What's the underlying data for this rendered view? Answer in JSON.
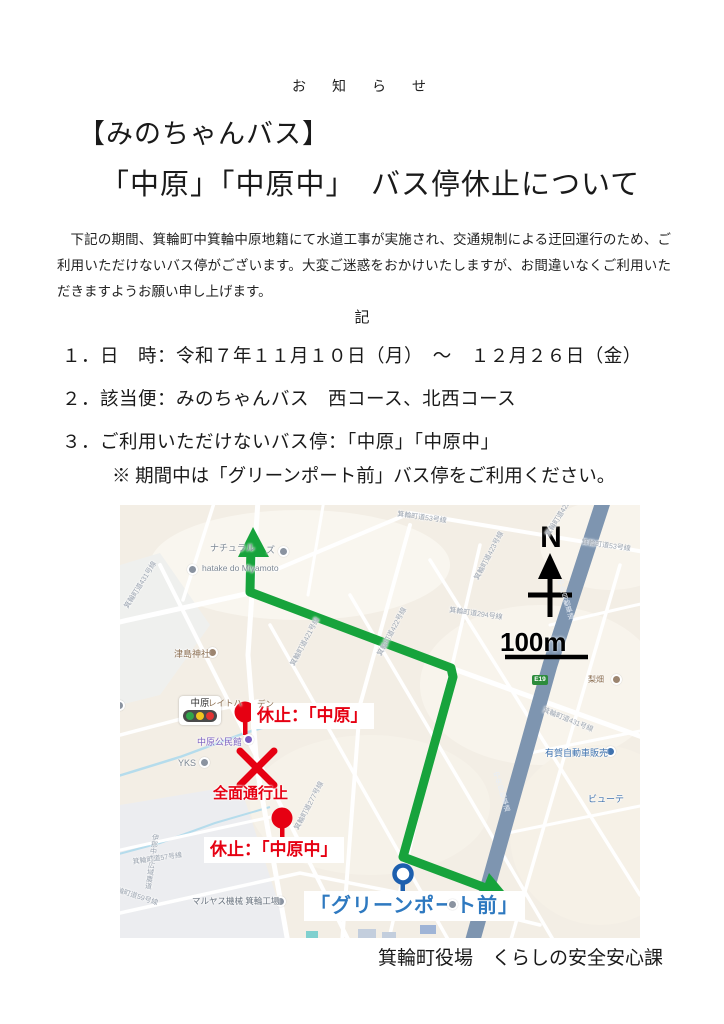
{
  "notice": {
    "header_label": "お　知　ら　せ",
    "title_line1": "【みのちゃんバス】",
    "title_line2": "「中原」「中原中」　バス停休止について",
    "body_paragraph": "下記の期間、箕輪町中箕輪中原地籍にて水道工事が実施され、交通規制による迂回運行のため、ご利用いただけないバス停がございます。大変ご迷惑をおかけいたしますが、お間違いなくご利用いただきますようお願い申し上げます。",
    "record_mark": "記",
    "items": [
      "１．日　時：令和７年１１月１０日（月）　～　１２月２６日（金）",
      "２．該当便：みのちゃんバス　西コース、北西コース",
      "３．ご利用いただけないバス停：「中原」「中原中」"
    ],
    "note": "※ 期間中は「グリーンポート前」バス停をご利用ください。",
    "footer": "箕輪町役場　くらしの安全安心課"
  },
  "map": {
    "compass_label": "N",
    "scale_label": "100m",
    "expressway_badge": "E19",
    "colors": {
      "route_green": "#17a33c",
      "alert_red": "#e60012",
      "stop_blue": "#2e79c0",
      "expressway_blue": "#7e95b0",
      "map_background": "#f3eee5"
    },
    "signal_name": "中原",
    "annotations": {
      "suspended_nakahara": "休止：「中原」",
      "suspended_nakahara_naka": "休止：「中原中」",
      "closure": "全面通行止",
      "greenport": "「グリーンポート前」"
    },
    "pois": [
      {
        "text": "ナチュラル"
      },
      {
        "text": "ズ"
      },
      {
        "text": "hatake do Miyamoto"
      },
      {
        "text": "津島神社"
      },
      {
        "text": "レイトハ"
      },
      {
        "text": "デン"
      },
      {
        "text": "中原公民館"
      },
      {
        "text": "YKS"
      },
      {
        "text": "マルヤス機械 箕輪工場"
      },
      {
        "text": "有賀自動車販売"
      },
      {
        "text": "ビューテ"
      },
      {
        "text": "梨畑"
      }
    ],
    "road_labels": [
      {
        "text": "箕輪町道53号線"
      },
      {
        "text": "箕輪町道422号線"
      },
      {
        "text": "箕輪町道53号線"
      },
      {
        "text": "箕輪町道423号線"
      },
      {
        "text": "箕輪町道294号線"
      },
      {
        "text": "箕輪町道431号線"
      },
      {
        "text": "箕輪町道421号線"
      },
      {
        "text": "箕輪町道422号線"
      },
      {
        "text": "箕輪町道431号線"
      },
      {
        "text": "箕輪町道277号線"
      },
      {
        "text": "伊那中部広域農道"
      },
      {
        "text": "箕輪町道59号線"
      },
      {
        "text": "箕輪町道57号線"
      },
      {
        "text": "中央自動車道"
      },
      {
        "text": "中央自動車道"
      }
    ]
  }
}
